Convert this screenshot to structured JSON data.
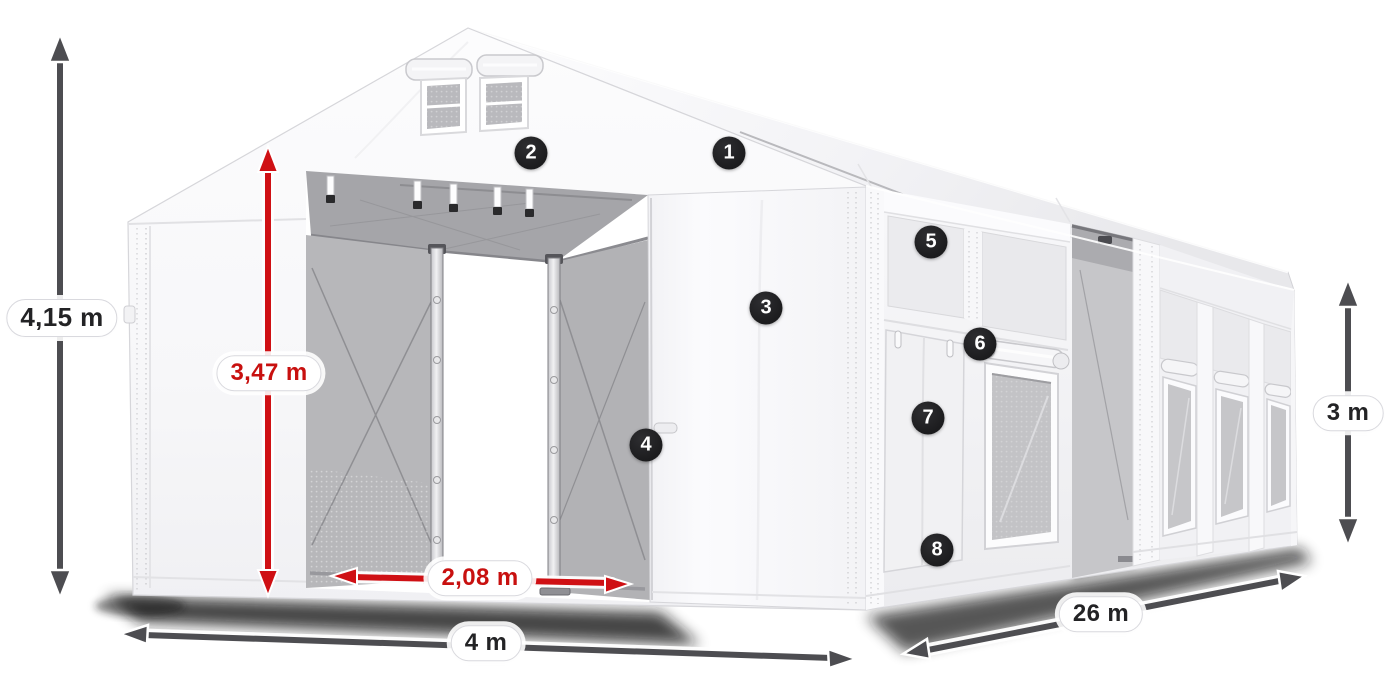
{
  "dimensions": [
    {
      "id": "total_height",
      "label": "4,15 m",
      "style": "dark"
    },
    {
      "id": "inner_height",
      "label": "3,47 m",
      "style": "red"
    },
    {
      "id": "entrance_width",
      "label": "2,08 m",
      "style": "red"
    },
    {
      "id": "width",
      "label": "4 m",
      "style": "dark"
    },
    {
      "id": "length",
      "label": "26 m",
      "style": "dark"
    },
    {
      "id": "side_height",
      "label": "3 m",
      "style": "dark"
    }
  ],
  "markers": [
    {
      "number": "1"
    },
    {
      "number": "2"
    },
    {
      "number": "3"
    },
    {
      "number": "4"
    },
    {
      "number": "5"
    },
    {
      "number": "6"
    },
    {
      "number": "7"
    },
    {
      "number": "8"
    }
  ],
  "colors": {
    "accent_red": "#c8100f",
    "arrow_dark": "#4d4d51",
    "badge_background": "#1e1e20",
    "tent_white": "#f7f7f9",
    "interior_gray": "#b4b4b8"
  }
}
